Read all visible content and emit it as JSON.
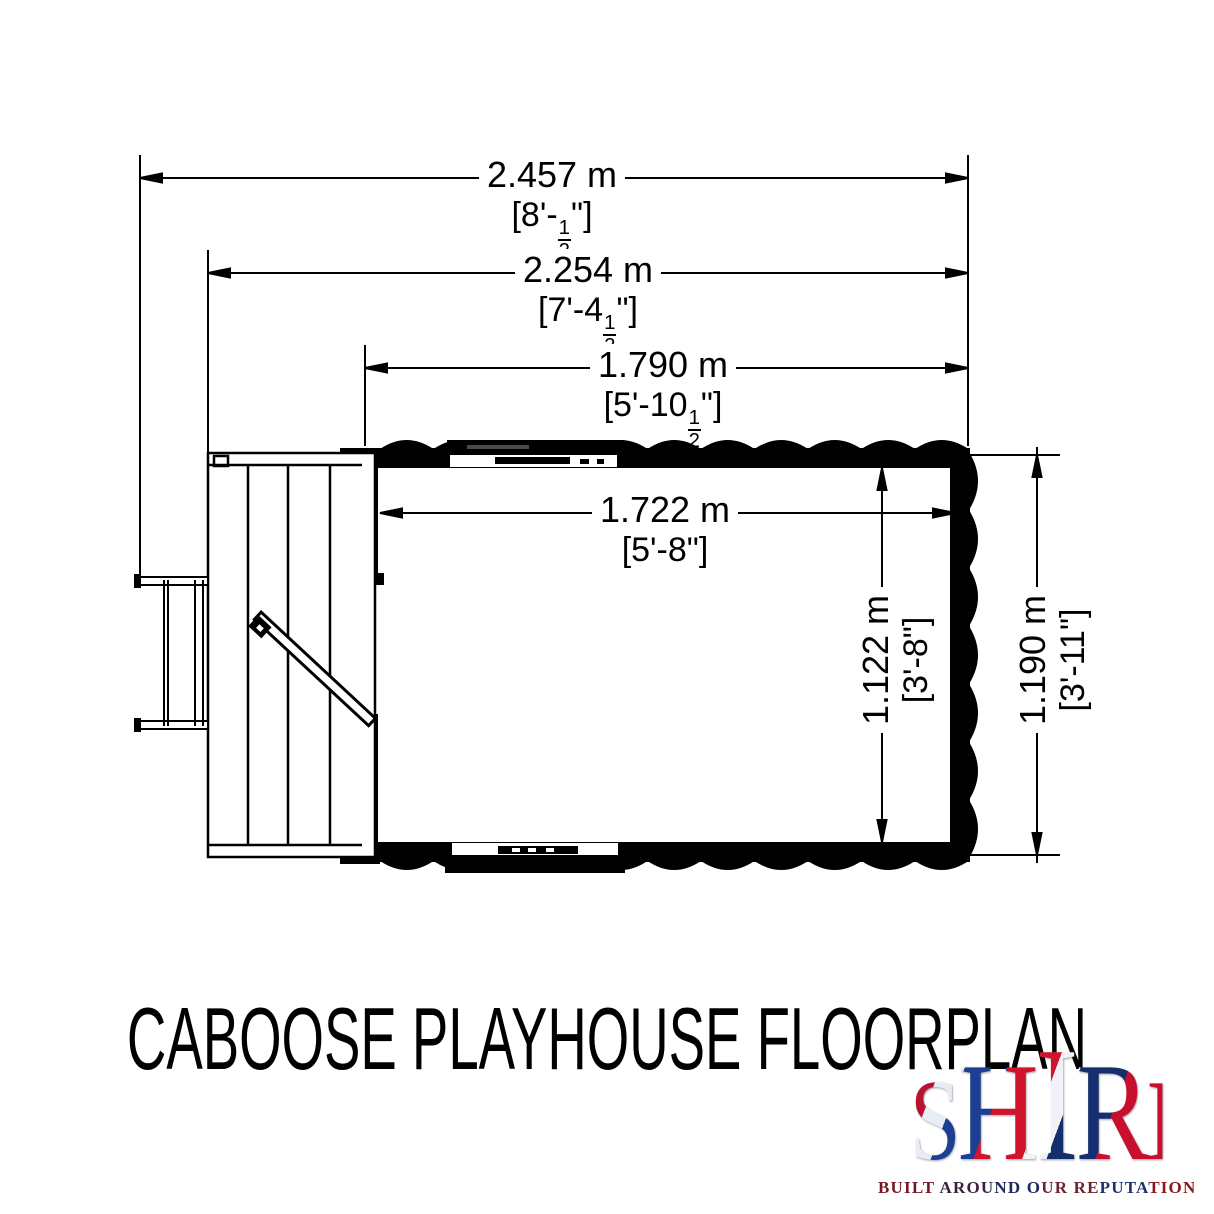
{
  "title": {
    "text": "CABOOSE PLAYHOUSE FLOORPLAN"
  },
  "dimensions": {
    "overall_width": {
      "metric": "2.457 m",
      "imp_pre": "[8'-",
      "imp_num": "1",
      "imp_den": "2",
      "imp_post": "\"]"
    },
    "body_width": {
      "metric": "2.254 m",
      "imp_pre": "[7'-4",
      "imp_num": "1",
      "imp_den": "2",
      "imp_post": "\"]"
    },
    "cabin_width": {
      "metric": "1.790 m",
      "imp_pre": "[5'-10",
      "imp_num": "1",
      "imp_den": "2",
      "imp_post": "\"]"
    },
    "interior_width": {
      "metric": "1.722 m",
      "imp_pre": "[5'-8\"]",
      "imp_num": "",
      "imp_den": "",
      "imp_post": ""
    },
    "interior_depth": {
      "metric": "1.122 m",
      "imp_pre": "[3'-8\"]",
      "imp_num": "",
      "imp_den": "",
      "imp_post": ""
    },
    "overall_depth": {
      "metric": "1.190 m",
      "imp_pre": "[3'-11\"]",
      "imp_num": "",
      "imp_den": "",
      "imp_post": ""
    }
  },
  "logo": {
    "letters": [
      "S",
      "H",
      "I",
      "R",
      "E"
    ],
    "tagline": "BUILT AROUND OUR REPUTATION",
    "colors": {
      "flag_red": "#C8102E",
      "flag_blue": "#012169",
      "ink": "#000000",
      "paper": "#FFFFFF"
    }
  }
}
